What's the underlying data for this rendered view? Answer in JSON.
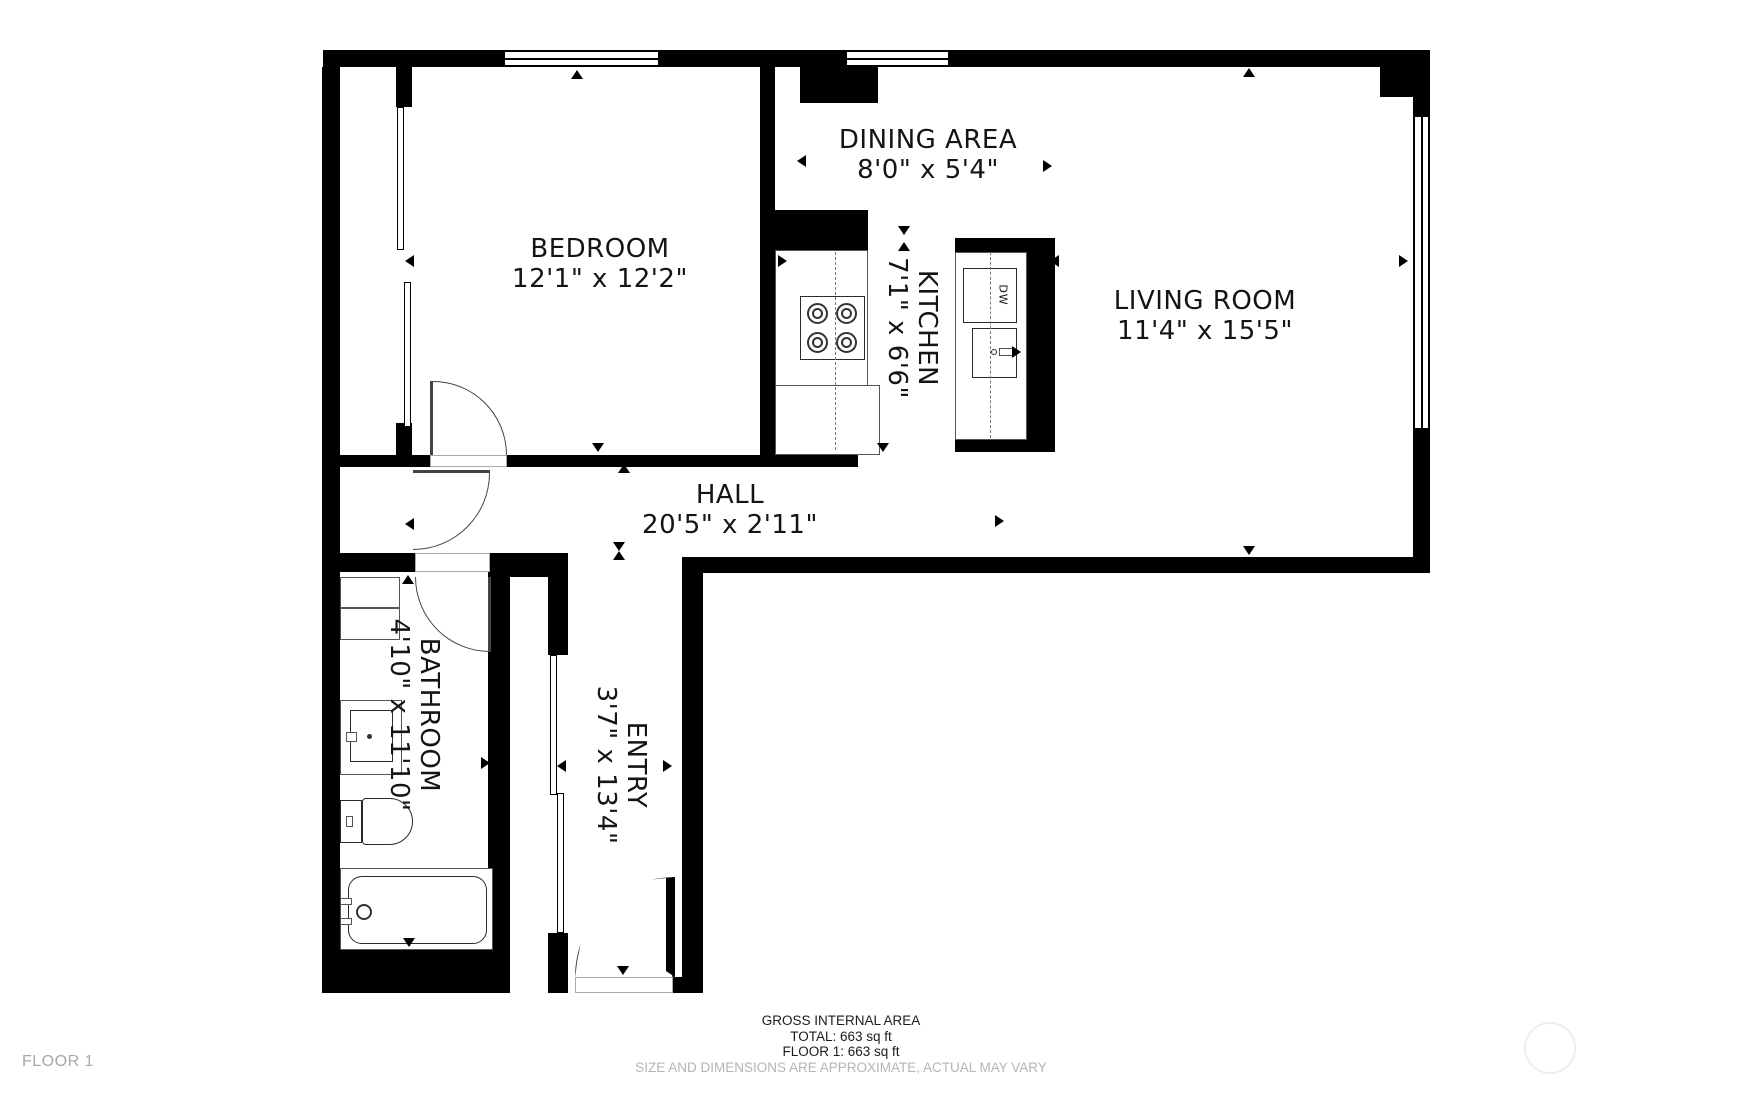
{
  "plan": {
    "floor_label": "FLOOR 1",
    "footer": {
      "title": "GROSS INTERNAL AREA",
      "total": "TOTAL: 663 sq ft",
      "floor1": "FLOOR 1: 663 sq ft",
      "disclaimer": "SIZE AND DIMENSIONS ARE APPROXIMATE, ACTUAL MAY VARY"
    },
    "colors": {
      "wall": "#000000",
      "text": "#141414",
      "muted": "#a8a8a8",
      "disclaimer": "#b5b5b5"
    }
  },
  "rooms": {
    "bedroom": {
      "name": "BEDROOM",
      "dims": "12'1\" x 12'2\""
    },
    "dining": {
      "name": "DINING AREA",
      "dims": "8'0\" x 5'4\""
    },
    "kitchen": {
      "name": "KITCHEN",
      "dims": "7'1\" x 6'6\""
    },
    "living": {
      "name": "LIVING ROOM",
      "dims": "11'4\" x 15'5\""
    },
    "hall": {
      "name": "HALL",
      "dims": "20'5\" x 2'11\""
    },
    "bathroom": {
      "name": "BATHROOM",
      "dims": "4'10\" x 11'10\""
    },
    "entry": {
      "name": "ENTRY",
      "dims": "3'7\" x 13'4\""
    }
  },
  "appliances": {
    "dishwasher": "DW"
  }
}
